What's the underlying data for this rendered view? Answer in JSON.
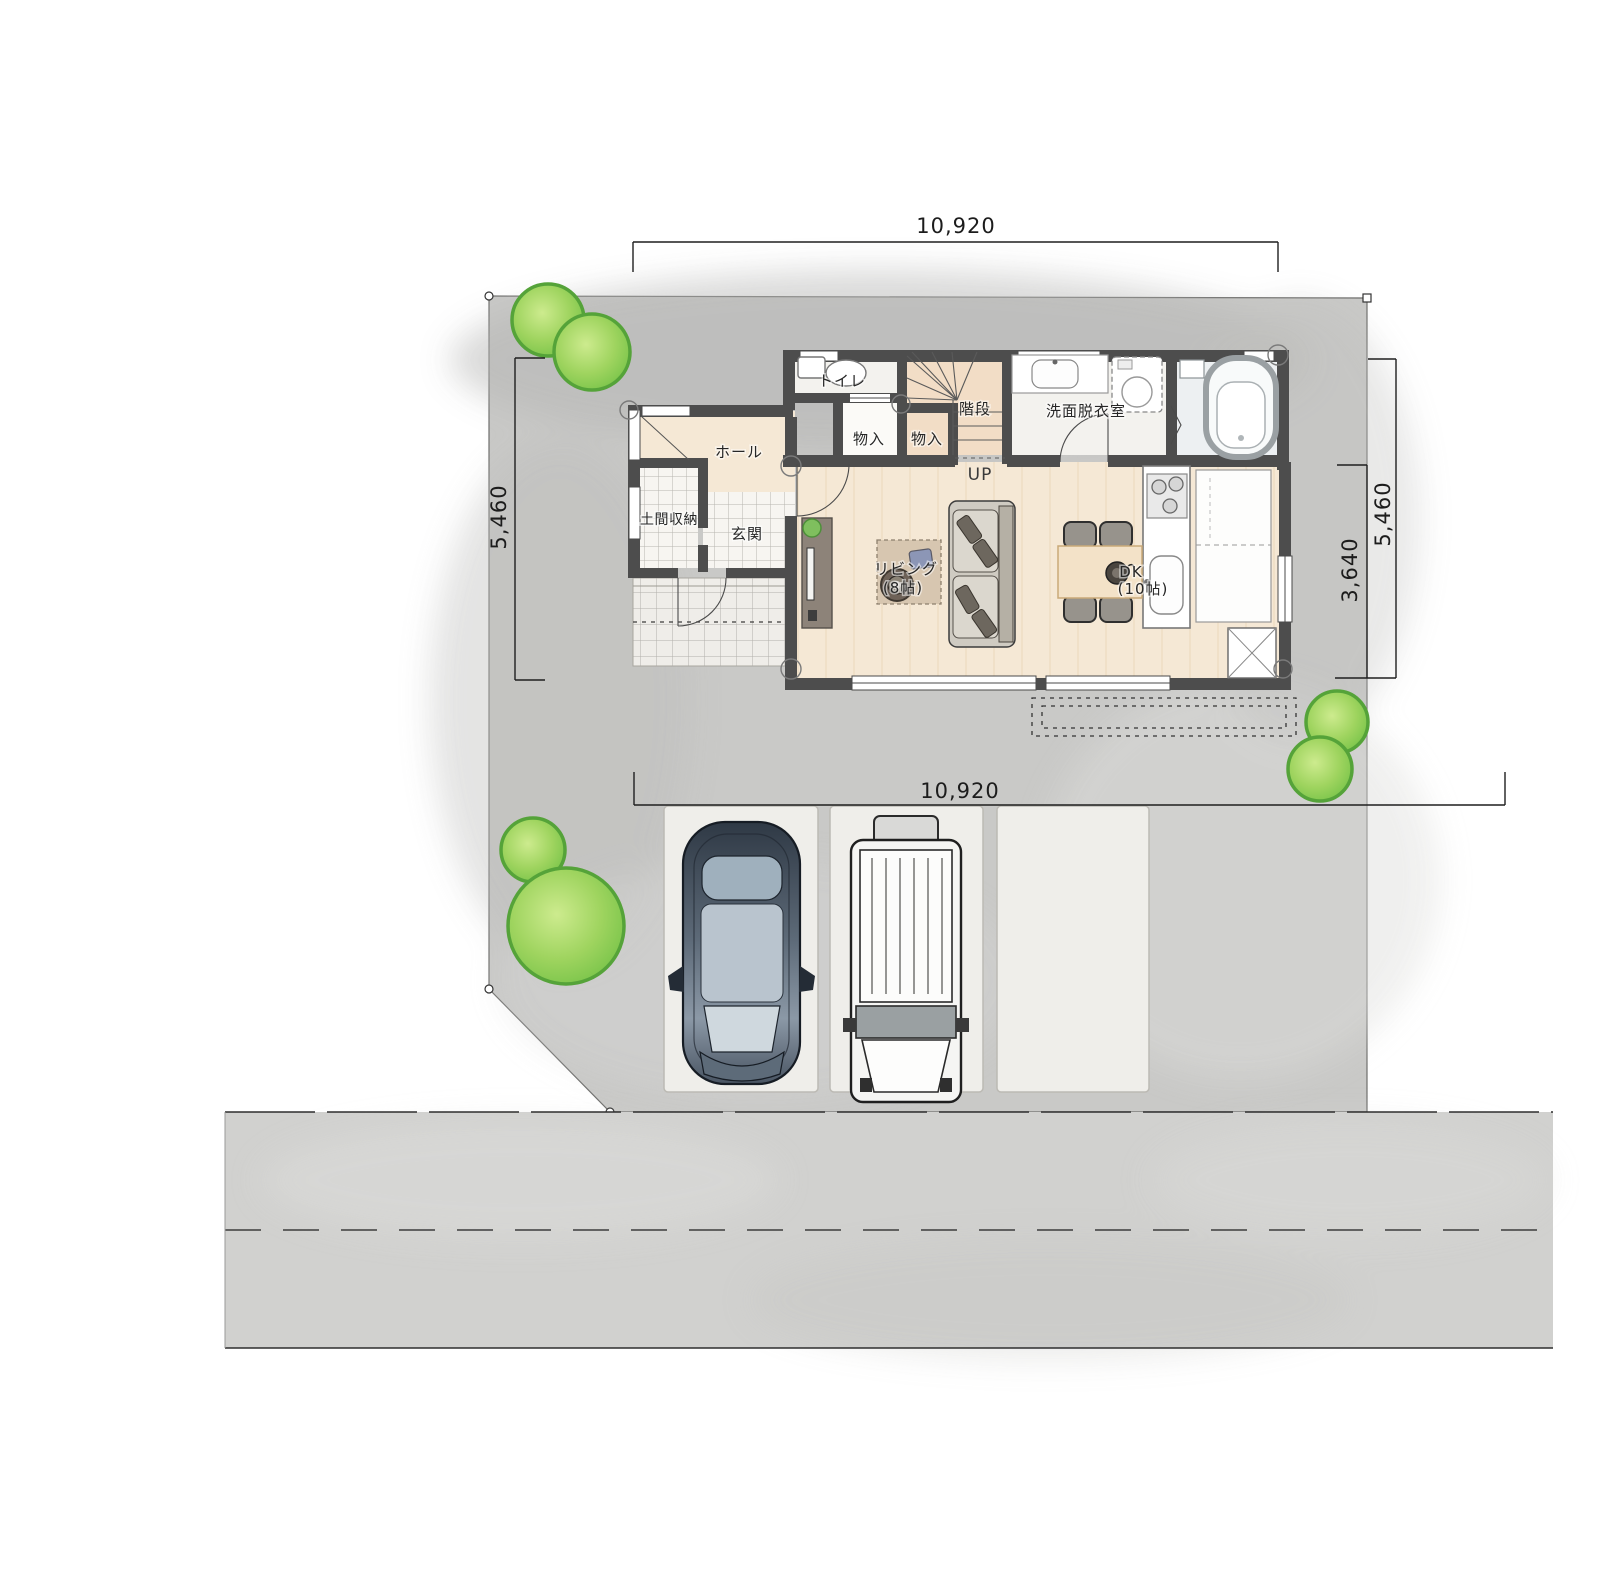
{
  "plan": {
    "type": "site-floor-plan",
    "dimensions": {
      "top": "10,920",
      "bottom": "10,920",
      "left": "5,460",
      "right_outer": "5,460",
      "right_inner": "3,640"
    },
    "labels": {
      "toilet": "トイレ",
      "stairs": "階段",
      "storage1": "物入",
      "storage2": "物入",
      "up": "UP",
      "washroom": "洗面脱衣室",
      "hall": "ホール",
      "doma_storage": "土間収納",
      "entrance": "玄関",
      "living_name": "リビング",
      "living_size": "(8帖)",
      "dk_name": "DK",
      "dk_size": "(10帖)"
    }
  },
  "colors": {
    "site": "#c9c9c7",
    "road": "#d1d1cf",
    "wall": "#4d4d4d",
    "floor": "#f5e8d5",
    "floor-stairs": "#f2ddc6",
    "tile": "#f7f5f1",
    "room-white": "#f3f2ee",
    "bath": "#edf0f2",
    "closet": "#fbfaf7",
    "tree-edge": "#55a339",
    "tree-fill": "#9fd45f",
    "tree-light": "#cdeb8e",
    "line": "#222222",
    "pad": "#efeeea",
    "rug": "#d7c6b0",
    "sofa": "#cfcbc2",
    "wood-dark": "#8d8379",
    "table": "#f3e2c8",
    "counter": "#ffffff"
  }
}
